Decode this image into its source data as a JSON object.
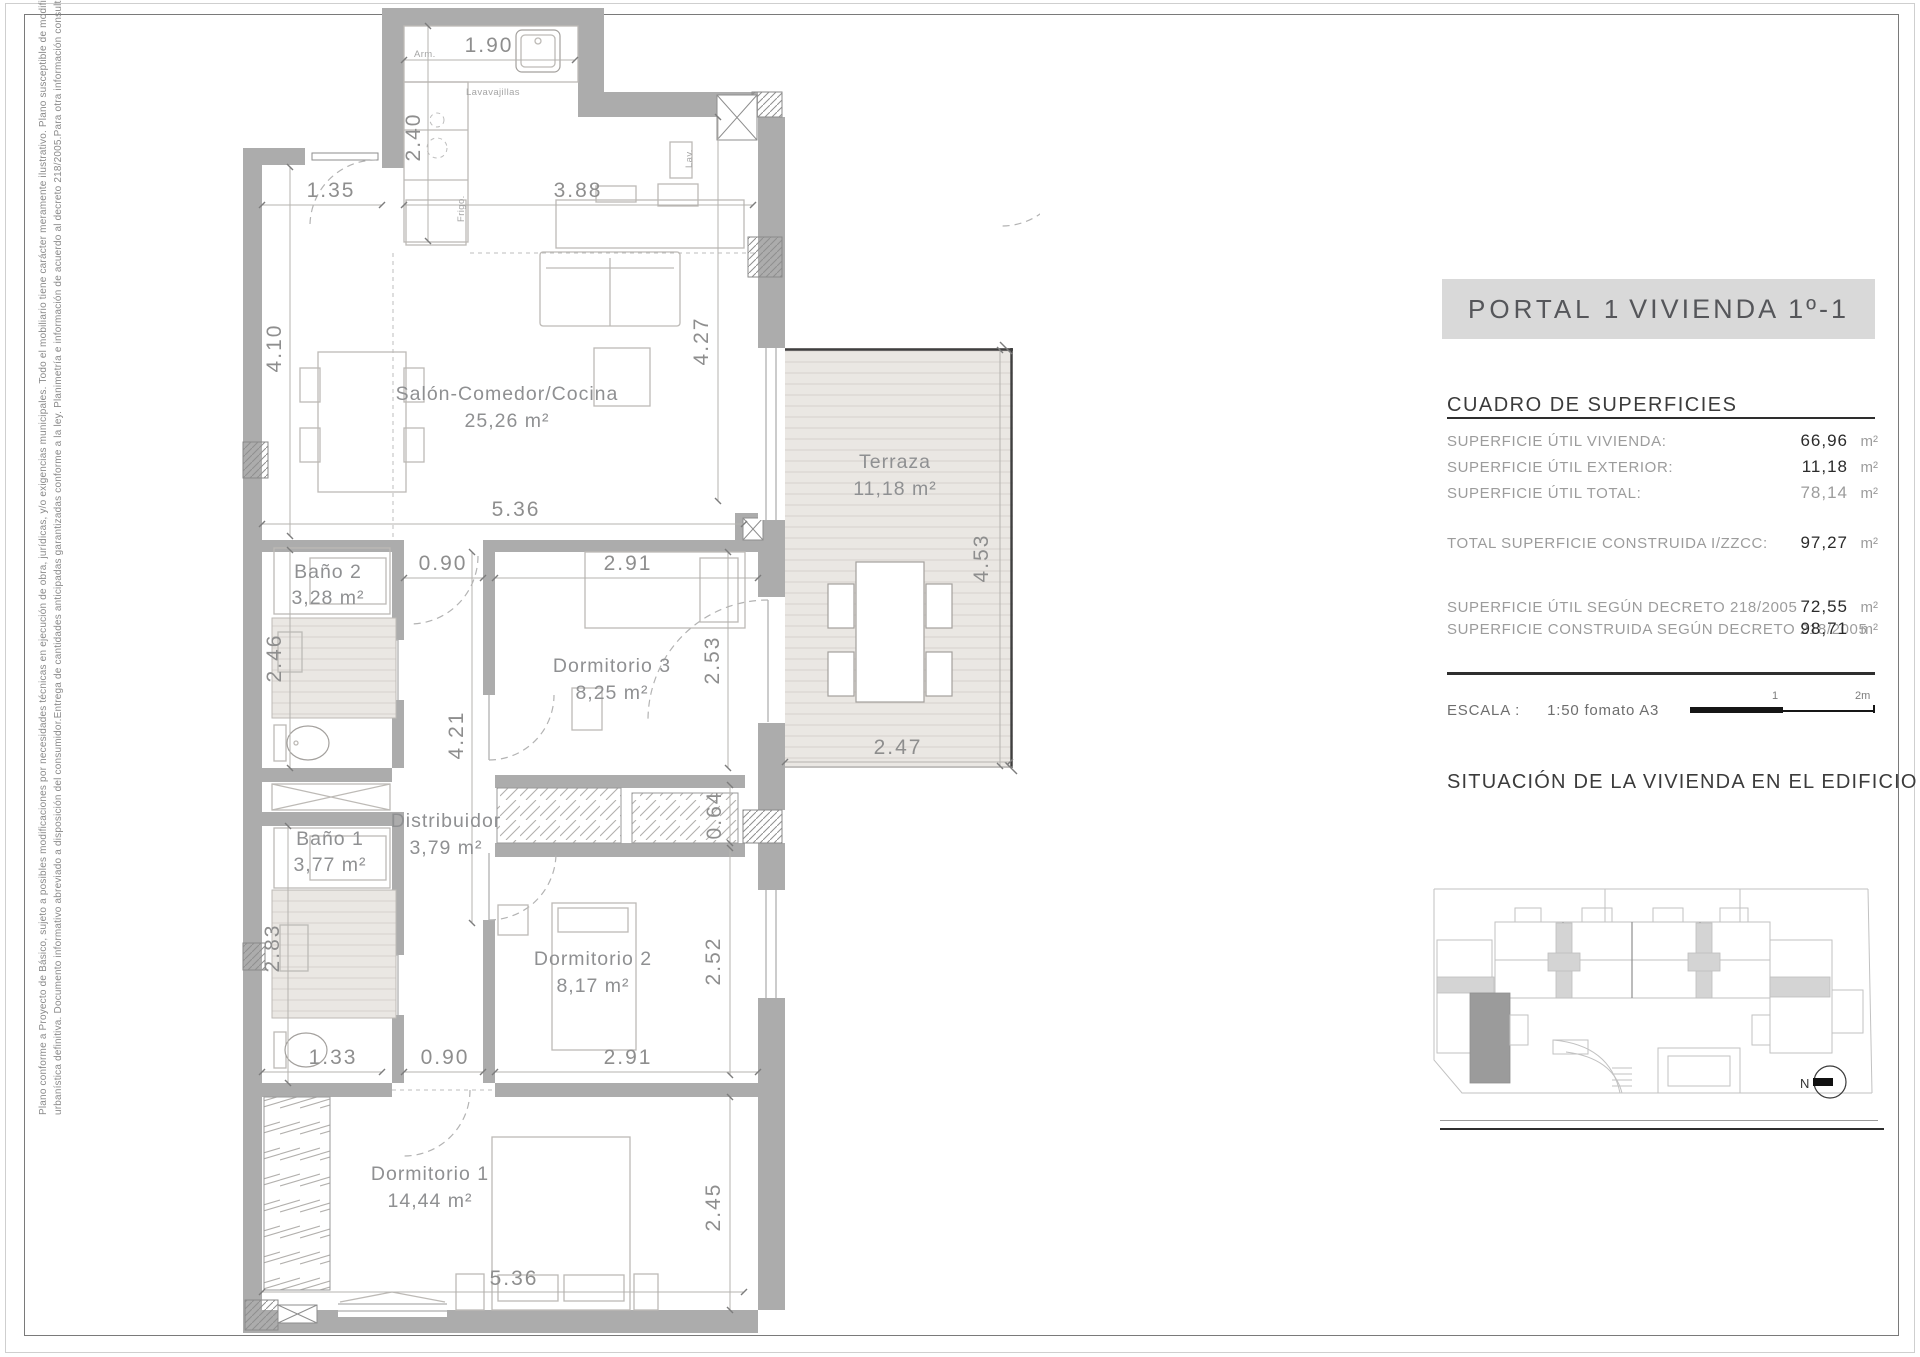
{
  "disclaimer": {
    "line1": "Plano conforme a Proyecto de Básico, sujeto a posibles modificaciones por necesidades técnicas en ejecución de obra, jurídicas, y/o exigencias municipales. Todo el mobiliario tiene carácter meramente ilustrativo. Plano susceptible de modificaciones hasta aprobación",
    "line2": "urbanística definitiva. Documento informativo abreviado a disposición del consumidor.Entrega de cantidades anticipadas garantizadas conforme a la ley. Planimetría e información de acuerdo al decreto 218/2005.Para otra información consultar en punto de venta."
  },
  "panel": {
    "portal": "PORTAL 1",
    "vivienda": "VIVIENDA 1º-1",
    "surfaces_title": "CUADRO DE SUPERFICIES",
    "rows": [
      {
        "label": "SUPERFICIE ÚTIL VIVIENDA:",
        "value": "66,96",
        "unit": "m²"
      },
      {
        "label": "SUPERFICIE ÚTIL EXTERIOR:",
        "value": "11,18",
        "unit": "m²"
      },
      {
        "label": "SUPERFICIE ÚTIL TOTAL:",
        "value": "78,14",
        "unit": "m²"
      },
      {
        "label": "TOTAL SUPERFICIE CONSTRUIDA I/ZZCC:",
        "value": "97,27",
        "unit": "m²"
      },
      {
        "label": "SUPERFICIE ÚTIL SEGÚN DECRETO 218/2005",
        "value": "72,55",
        "unit": "m²"
      },
      {
        "label": "SUPERFICIE CONSTRUIDA SEGÚN DECRETO 218/2005",
        "value": "98,71",
        "unit": "m²"
      }
    ],
    "escala_label": "ESCALA :",
    "escala_value": "1:50 fomato A3",
    "scalebar": {
      "mid": "1",
      "end": "2m"
    },
    "situacion_title": "SITUACIÓN DE LA VIVIENDA EN EL EDIFICIO",
    "north_label": "N"
  },
  "plan": {
    "rooms": [
      {
        "name": "Salón-Comedor/Cocina",
        "area": "25,26 m²"
      },
      {
        "name": "Terraza",
        "area": "11,18 m²"
      },
      {
        "name": "Baño 2",
        "area": "3,28 m²"
      },
      {
        "name": "Dormitorio 3",
        "area": "8,25 m²"
      },
      {
        "name": "Distribuidor",
        "area": "3,79 m²"
      },
      {
        "name": "Baño 1",
        "area": "3,77 m²"
      },
      {
        "name": "Dormitorio 2",
        "area": "8,17 m²"
      },
      {
        "name": "Dormitorio 1",
        "area": "14,44 m²"
      }
    ],
    "dims": [
      "1.90",
      "2.40",
      "1.35",
      "3.88",
      "4.10",
      "4.27",
      "5.36",
      "0.90",
      "2.91",
      "2.46",
      "2.53",
      "4.53",
      "2.47",
      "4.21",
      "0.64",
      "2.83",
      "2.52",
      "1.33",
      "0.90",
      "2.91",
      "2.45",
      "5.36"
    ],
    "appliances": [
      "Arm.",
      "Lavavajillas",
      "Frigo.",
      "Lav."
    ],
    "colors": {
      "wall": "#acacac",
      "terrace_floor": "#eae7e3",
      "highlight_unit": "#9b9b9b",
      "titlebar": "#d9d9d9"
    }
  }
}
